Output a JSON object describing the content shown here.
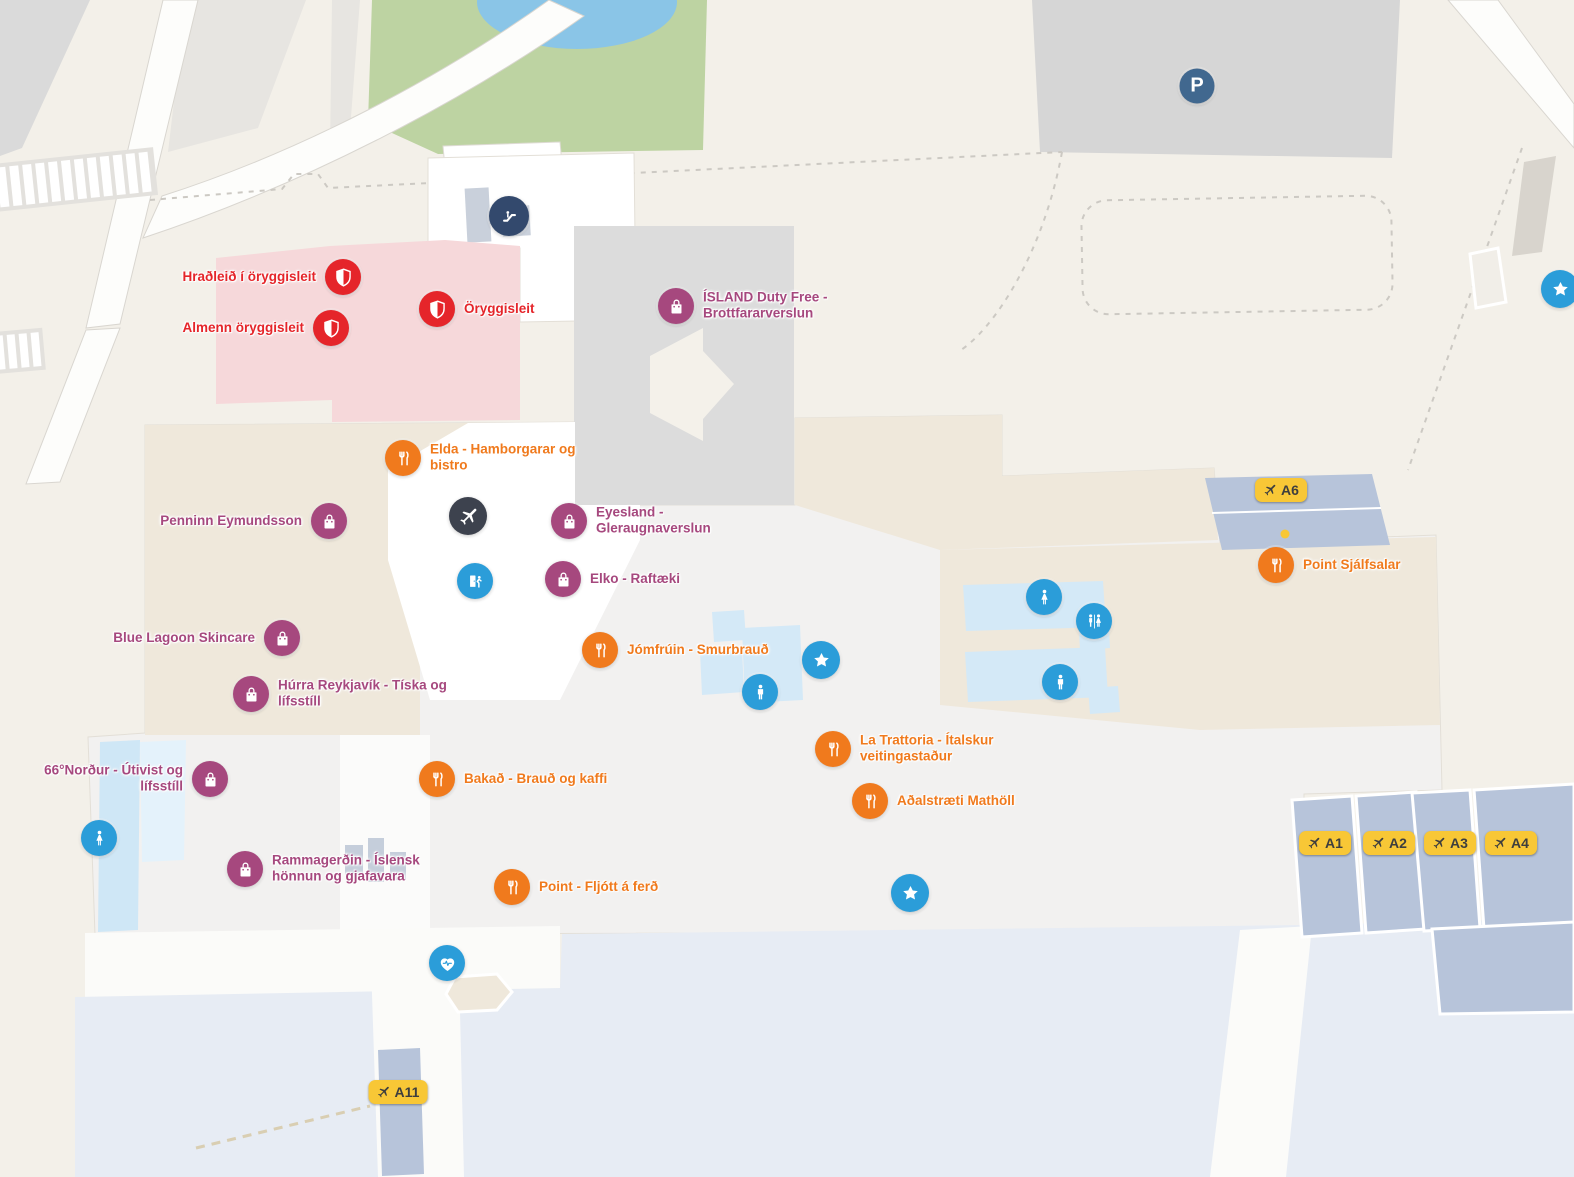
{
  "app": {
    "title": "Airport terminal indoor map"
  },
  "colors": {
    "security": "#e5252a",
    "shop": "#a6487e",
    "dining": "#f07a1d",
    "info_blue": "#2b9dd9",
    "dark_plane": "#3d424e",
    "escalator_navy": "#33496d",
    "parking_blue": "#41688f",
    "gate_yellow": "#f8c736",
    "gate_text": "#3e3e3e",
    "security_zone_pink": "#f6d8da",
    "building_gray": "#dcdcdc",
    "floor_beige": "#efe8db",
    "floor_light": "#f2f1f0",
    "toilet_blue_light": "#d4e9f7",
    "gate_stand_blue": "#b7c4da",
    "apron_blue": "#e7ecf4",
    "park_green": "#bdd3a2",
    "pond_blue": "#8ac5e7",
    "outdoor_gray": "#d9d9d9"
  },
  "markers": [
    {
      "type": "escalator",
      "x": 509,
      "y": 216
    },
    {
      "type": "parking",
      "x": 1197,
      "y": 86,
      "label": "P",
      "side": "in"
    },
    {
      "type": "security",
      "x": 343,
      "y": 277,
      "label": "Hraðleið í öryggisleit",
      "side": "left"
    },
    {
      "type": "security",
      "x": 437,
      "y": 309,
      "label": "Öryggisleit",
      "side": "right"
    },
    {
      "type": "security",
      "x": 331,
      "y": 328,
      "label": "Almenn öryggisleit",
      "side": "left"
    },
    {
      "type": "shop",
      "x": 676,
      "y": 306,
      "label": "ÍSLAND Duty Free - Brottfararverslun",
      "side": "right",
      "w": 140
    },
    {
      "type": "dining",
      "x": 403,
      "y": 458,
      "label": "Elda - Hamborgarar og bistro",
      "side": "right",
      "w": 160
    },
    {
      "type": "plane",
      "x": 468,
      "y": 516
    },
    {
      "type": "shop",
      "x": 329,
      "y": 521,
      "label": "Penninn Eymundsson",
      "side": "left"
    },
    {
      "type": "shop",
      "x": 569,
      "y": 521,
      "label": "Eyesland - Gleraugnaverslun",
      "side": "right",
      "w": 140
    },
    {
      "type": "exit",
      "x": 475,
      "y": 581
    },
    {
      "type": "shop",
      "x": 563,
      "y": 579,
      "label": "Elko - Raftæki",
      "side": "right"
    },
    {
      "type": "shop",
      "x": 282,
      "y": 638,
      "label": "Blue Lagoon Skincare",
      "side": "left"
    },
    {
      "type": "dining",
      "x": 600,
      "y": 650,
      "label": "Jómfrúin - Smurbrauð",
      "side": "right"
    },
    {
      "type": "star",
      "x": 821,
      "y": 660
    },
    {
      "type": "toilet_male",
      "x": 760,
      "y": 692
    },
    {
      "type": "shop",
      "x": 251,
      "y": 694,
      "label": "Húrra Reykjavík - Tíska og lífsstíll",
      "side": "right",
      "w": 170
    },
    {
      "type": "gate",
      "x": 1281,
      "y": 490,
      "label": "A6"
    },
    {
      "type": "dot",
      "x": 1285,
      "y": 534
    },
    {
      "type": "dining",
      "x": 1276,
      "y": 565,
      "label": "Point Sjálfsalar",
      "side": "right"
    },
    {
      "type": "toilet_female",
      "x": 1044,
      "y": 597
    },
    {
      "type": "toilet_unisex",
      "x": 1094,
      "y": 621
    },
    {
      "type": "toilet_male",
      "x": 1060,
      "y": 682
    },
    {
      "type": "star",
      "x": 1560,
      "y": 289
    },
    {
      "type": "shop",
      "x": 210,
      "y": 779,
      "label": "66°Norður - Útivist og lífsstíll",
      "side": "left",
      "w": 155
    },
    {
      "type": "dining",
      "x": 437,
      "y": 779,
      "label": "Bakað - Brauð og kaffi",
      "side": "right"
    },
    {
      "type": "dining",
      "x": 833,
      "y": 749,
      "label": "La Trattoria - Ítalskur veitingastaður",
      "side": "right",
      "w": 165
    },
    {
      "type": "dining",
      "x": 870,
      "y": 801,
      "label": "Aðalstræti Mathöll",
      "side": "right"
    },
    {
      "type": "toilet_female",
      "x": 99,
      "y": 838
    },
    {
      "type": "shop",
      "x": 245,
      "y": 869,
      "label": "Rammagerðin - Íslensk hönnun og gjafavara",
      "side": "right",
      "w": 170
    },
    {
      "type": "dining",
      "x": 512,
      "y": 887,
      "label": "Point - Fljótt á ferð",
      "side": "right"
    },
    {
      "type": "star",
      "x": 910,
      "y": 893
    },
    {
      "type": "defib",
      "x": 447,
      "y": 963
    },
    {
      "type": "gate",
      "x": 398,
      "y": 1092,
      "label": "A11"
    },
    {
      "type": "gate",
      "x": 1325,
      "y": 843,
      "label": "A1"
    },
    {
      "type": "gate",
      "x": 1389,
      "y": 843,
      "label": "A2"
    },
    {
      "type": "gate",
      "x": 1450,
      "y": 843,
      "label": "A3"
    },
    {
      "type": "gate",
      "x": 1511,
      "y": 843,
      "label": "A4"
    }
  ]
}
